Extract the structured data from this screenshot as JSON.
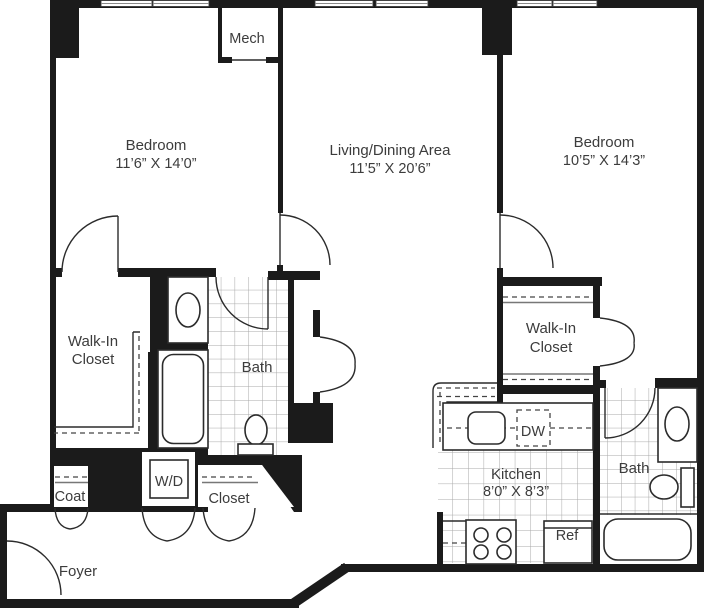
{
  "labels": {
    "mech": "Mech",
    "bedroom_1": {
      "name": "Bedroom",
      "dims": "11’6” X 14’0”"
    },
    "living": {
      "name": "Living/Dining Area",
      "dims": "11’5” X 20’6”"
    },
    "bedroom_2": {
      "name": "Bedroom",
      "dims": "10’5” X 14’3”"
    },
    "walkin_1": {
      "line1": "Walk-In",
      "line2": "Closet"
    },
    "bath_1": "Bath",
    "walkin_2": {
      "line1": "Walk-In",
      "line2": "Closet"
    },
    "coat": "Coat",
    "wd": "W/D",
    "closet": "Closet",
    "foyer": "Foyer",
    "kitchen": {
      "name": "Kitchen",
      "dims": "8’0” X 8’3”"
    },
    "dw": "DW",
    "ref": "Ref",
    "bath_2": "Bath"
  },
  "colors": {
    "wall": "#1b1b1b",
    "text": "#3c3c3c",
    "tile_line": "#a8a8a8",
    "background": "#ffffff"
  }
}
